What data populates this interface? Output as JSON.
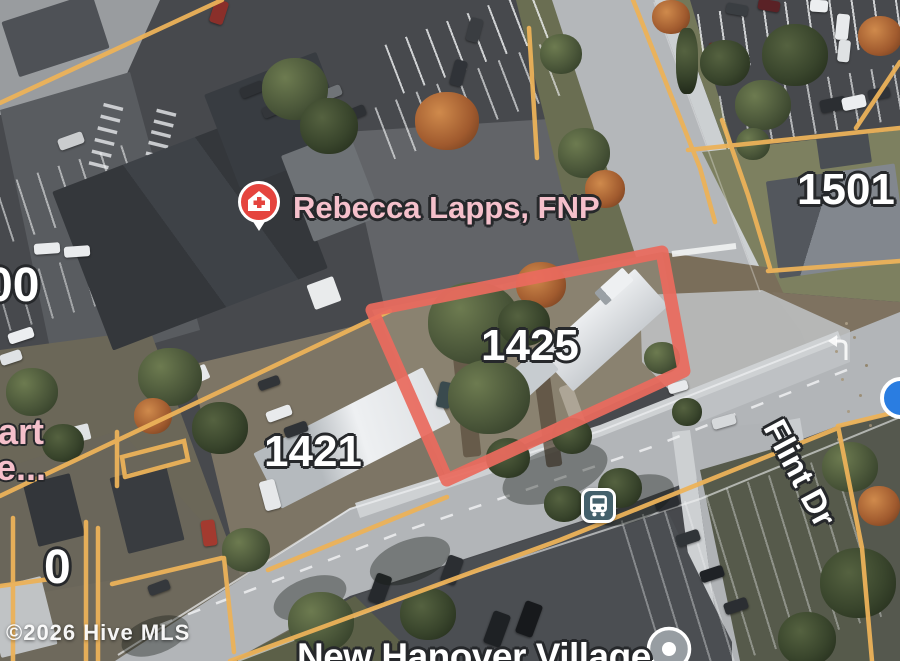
{
  "map": {
    "view": "satellite-aerial",
    "labels": {
      "poi_business": "Rebecca Lapps, FNP",
      "parcel_main": "1425",
      "parcel_left": "1421",
      "parcel_right": "1501",
      "street": "Flint Dr",
      "poi_bottom": "New Hanover Village",
      "watermark": "©2026 Hive MLS",
      "partial_address_top_left": "00",
      "partial_poi_line1": "art",
      "partial_poi_line2": "e...",
      "partial_address_bottom_left": "0"
    },
    "icons": {
      "medical_pin": "medical-place-pin",
      "bus_stop": "bus-stop",
      "generic_place_pin": "gray-place-pin",
      "blue_dot": "blue-location-dot"
    },
    "colors": {
      "parcel-outline": "#e96a5e",
      "parcel-lines": "#ecb259",
      "poi-pink": "#f5c0cb",
      "pin-red": "#e5443e",
      "bus-teal": "#44606b",
      "gray-pin": "#979da2",
      "blue-dot": "#2a7de1",
      "label-outline": "#26282b"
    }
  }
}
